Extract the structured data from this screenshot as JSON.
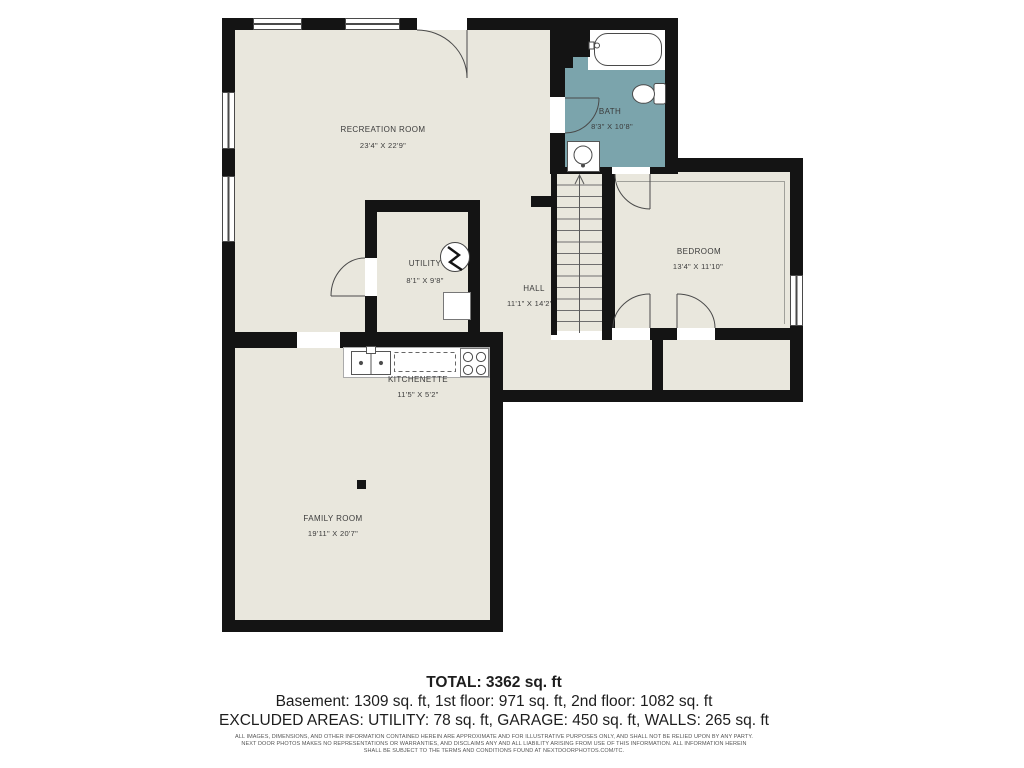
{
  "plan": {
    "rooms": {
      "recreation": {
        "name": "RECREATION ROOM",
        "dims": "23'4\" X 22'9\""
      },
      "bath": {
        "name": "BATH",
        "dims": "8'3\" X 10'8\""
      },
      "utility": {
        "name": "UTILITY",
        "dims": "8'1\" X 9'8\""
      },
      "hall": {
        "name": "HALL",
        "dims": "11'1\" X 14'2\""
      },
      "bedroom": {
        "name": "BEDROOM",
        "dims": "13'4\" X 11'10\""
      },
      "kitchenette": {
        "name": "KITCHENETTE",
        "dims": "11'5\" X 5'2\""
      },
      "family": {
        "name": "FAMILY ROOM",
        "dims": "19'11\" X 20'7\""
      }
    },
    "colors": {
      "floor": "#e9e7dd",
      "bath_floor": "#7ba4ac",
      "wall": "#141414",
      "label_text": "#3b3b3b"
    }
  },
  "summary": {
    "total": "TOTAL: 3362 sq. ft",
    "floors": "Basement: 1309 sq. ft, 1st floor: 971 sq. ft, 2nd floor: 1082 sq. ft",
    "excluded": "EXCLUDED AREAS: UTILITY: 78 sq. ft, GARAGE: 450 sq. ft, WALLS: 265 sq. ft"
  },
  "disclaimer": {
    "line1": "ALL IMAGES, DIMENSIONS, AND OTHER INFORMATION CONTAINED HEREIN ARE APPROXIMATE AND FOR ILLUSTRATIVE PURPOSES ONLY, AND SHALL NOT BE RELIED UPON BY ANY PARTY.",
    "line2": "NEXT DOOR PHOTOS MAKES NO REPRESENTATIONS OR WARRANTIES, AND DISCLAIMS ANY AND ALL LIABILITY ARISING FROM USE OF THIS INFORMATION. ALL INFORMATION HEREIN",
    "line3": "SHALL BE SUBJECT TO THE TERMS AND CONDITIONS FOUND AT NEXTDOORPHOTOS.COM/TC."
  }
}
